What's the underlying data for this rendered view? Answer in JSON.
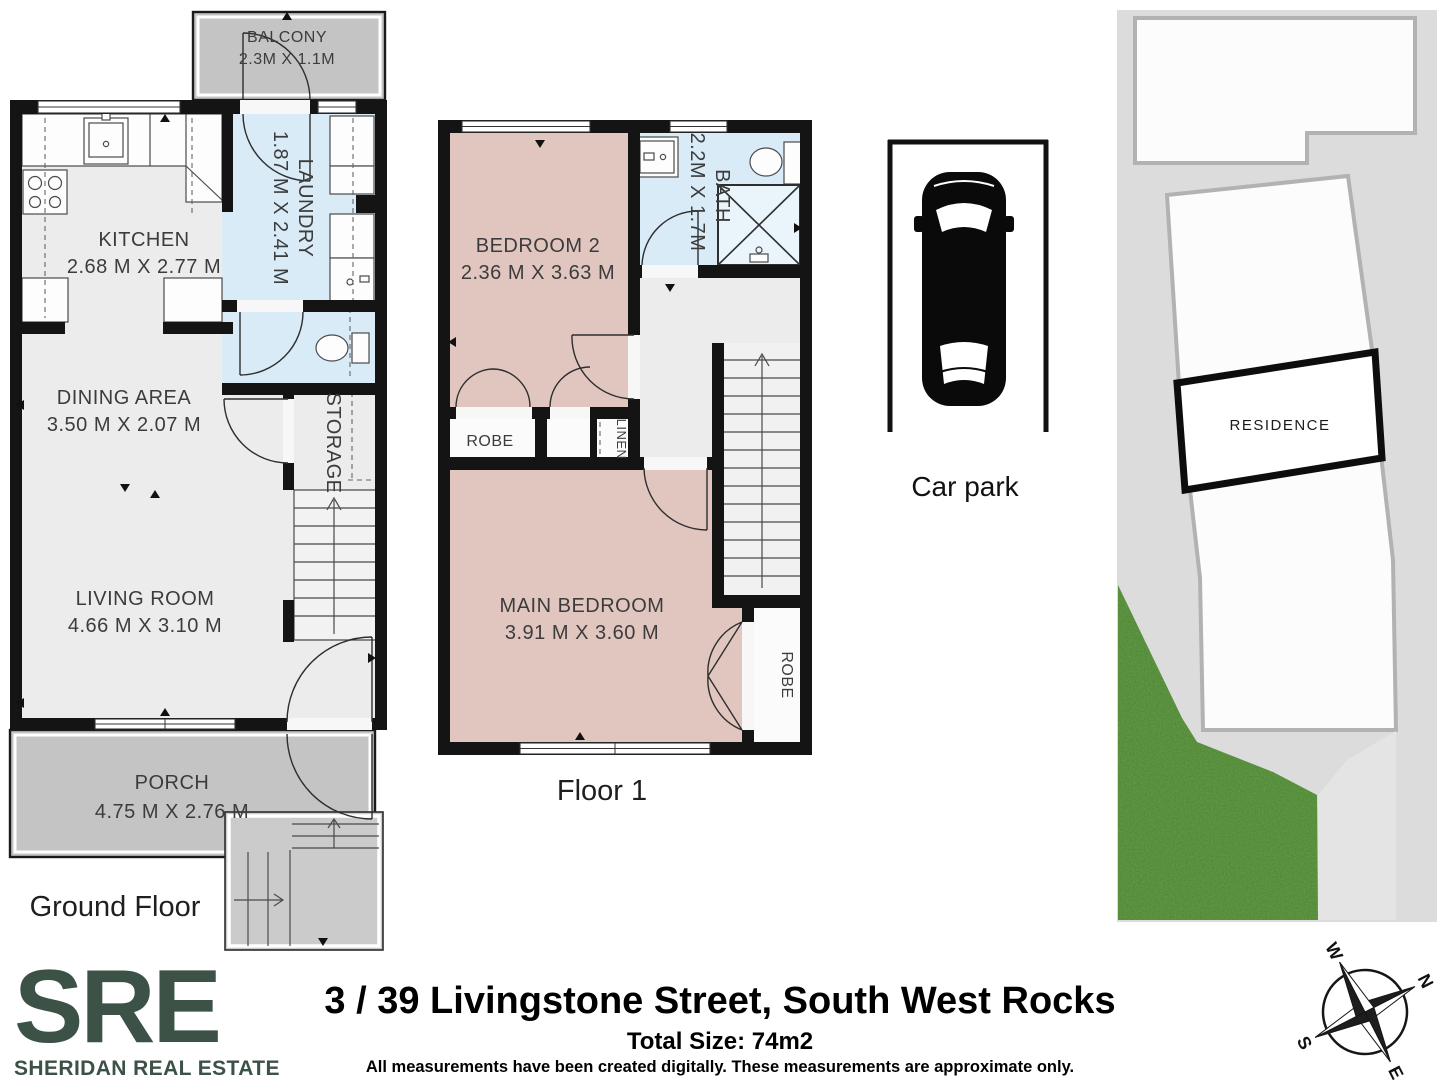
{
  "ground_floor": {
    "title": "Ground Floor",
    "balcony": {
      "name": "BALCONY",
      "dims": "2.3M X 1.1M"
    },
    "kitchen": {
      "name": "KITCHEN",
      "dims": "2.68 M X 2.77 M"
    },
    "laundry": {
      "name": "LAUNDRY",
      "dims": "1.87 M X 2.41 M"
    },
    "dining": {
      "name": "DINING AREA",
      "dims": "3.50 M X 2.07 M"
    },
    "storage": {
      "name": "STORAGE"
    },
    "living": {
      "name": "LIVING ROOM",
      "dims": "4.66 M X 3.10 M"
    },
    "porch": {
      "name": "PORCH",
      "dims": "4.75 M X 2.76 M"
    }
  },
  "floor_1": {
    "title": "Floor 1",
    "bedroom2": {
      "name": "BEDROOM 2",
      "dims": "2.36 M X 3.63 M"
    },
    "bath": {
      "name": "BATH",
      "dims": "2.2M X 1.7M"
    },
    "robe": {
      "name": "ROBE"
    },
    "linen": {
      "name": "LINEN"
    },
    "main_bedroom": {
      "name": "MAIN BEDROOM",
      "dims": "3.91 M X 3.60 M"
    },
    "robe2": {
      "name": "ROBE"
    }
  },
  "car_park": {
    "label": "Car park"
  },
  "site_plan": {
    "residence": "RESIDENCE"
  },
  "compass": {
    "n": "N",
    "e": "E",
    "s": "S",
    "w": "W"
  },
  "footer": {
    "logo": "SRE",
    "logo_subtitle": "SHERIDAN REAL ESTATE",
    "address": "3 / 39 Livingstone Street, South West Rocks",
    "total_size": "Total Size: 74m2",
    "disclaimer": "All measurements have been created digitally. These measurements are approximate only."
  },
  "colors": {
    "brand_green": "#3d5247",
    "wall": "#141414",
    "wet_room": "#d9ebf7",
    "bedroom": "#e1c6c0",
    "outdoor": "#c4c4c4",
    "floor": "#ececec",
    "site_background": "#dcdcdc",
    "grass": "#4e8531"
  }
}
